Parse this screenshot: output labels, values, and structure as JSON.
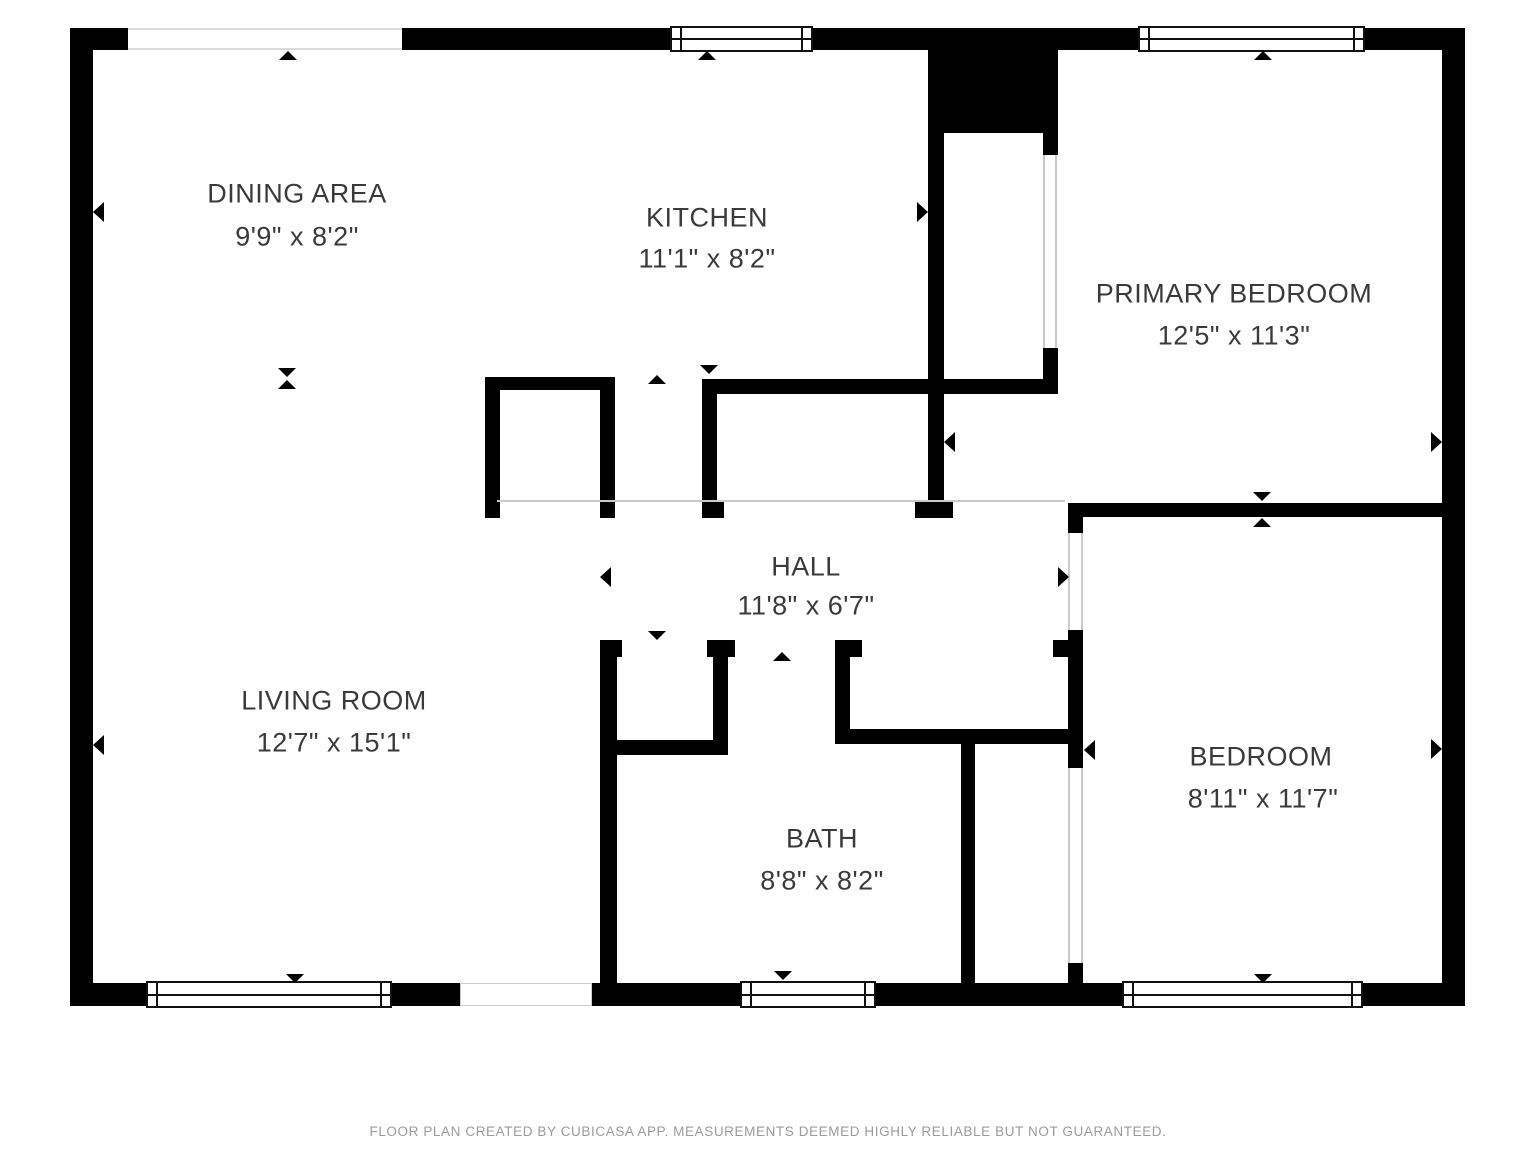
{
  "rooms": [
    {
      "name": "DINING AREA",
      "dims": "9'9\" x 8'2\""
    },
    {
      "name": "KITCHEN",
      "dims": "11'1\" x 8'2\""
    },
    {
      "name": "PRIMARY BEDROOM",
      "dims": "12'5\" x 11'3\""
    },
    {
      "name": "HALL",
      "dims": "11'8\" x 6'7\""
    },
    {
      "name": "LIVING ROOM",
      "dims": "12'7\" x 15'1\""
    },
    {
      "name": "BATH",
      "dims": "8'8\" x 8'2\""
    },
    {
      "name": "BEDROOM",
      "dims": "8'11\" x 11'7\""
    }
  ],
  "footer": "FLOOR PLAN CREATED BY CUBICASA APP. MEASUREMENTS DEEMED HIGHLY RELIABLE BUT NOT GUARANTEED.",
  "colors": {
    "wall": "#000000",
    "label": "#3a3a3a",
    "footer_text": "#9b9b9b",
    "open_boundary": "#c9c9c9",
    "background": "#ffffff"
  }
}
